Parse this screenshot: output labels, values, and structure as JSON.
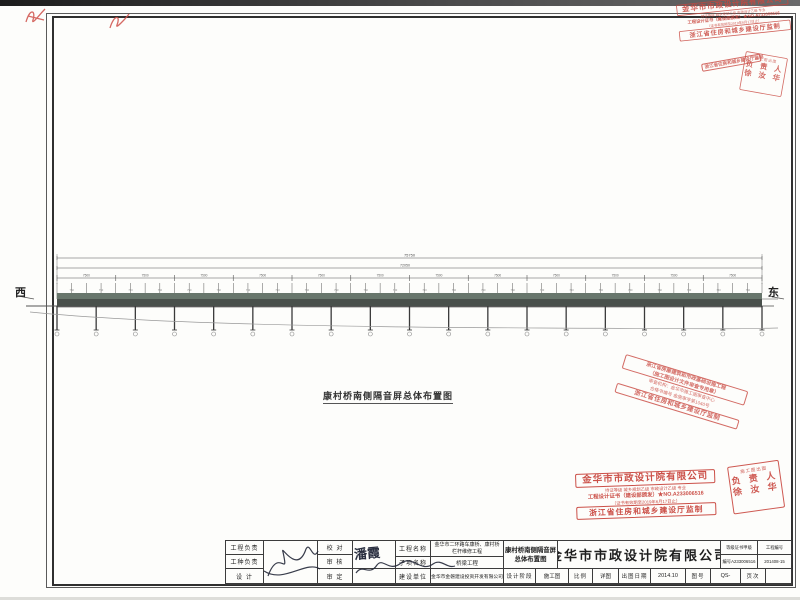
{
  "colors": {
    "stamp_red": "#c9473f",
    "ink": "#2a2f40",
    "deck_dark": "#49504b",
    "deck_hatch": "#77857a"
  },
  "orientation": {
    "west": "西",
    "east": "东"
  },
  "caption": "康村桥南侧隔音屏总体布置图",
  "drawing": {
    "total_dim": "75750",
    "sub_dim": "72050",
    "span_dim": "7500",
    "panel_dim": "750",
    "spans": 12,
    "piers": 19,
    "posts": 48
  },
  "review_stamp": {
    "top1": "浙江省房屋建筑和市政基础设施工程",
    "top2": "（施工图设计文件审查专用章）",
    "mid1": "审查机构：金华市施工图审查中心",
    "mid2": "合格书编号 金施审字第1040号",
    "bottom": "浙江省住房和城乡建设厅监制"
  },
  "certificate_stamp": {
    "company": "金华市市政设计院有限公司",
    "line2": "持证等级 城乡规划乙级 市政设计乙级 专业",
    "line3": "工程设计证书（建设部颁发）★NO.A233006516",
    "line4": "（证书有效期至2019年6月17日止）",
    "footer": "浙江省住房和城乡建设厅监制"
  },
  "square_stamp": {
    "line1": "施工图出图",
    "line2": "负 责 人",
    "line3": "徐 汝 华"
  },
  "title_block": {
    "row_labels_1": [
      "工程负责",
      "工种负责",
      "设  计"
    ],
    "row_labels_2": [
      "校  对",
      "审  核",
      "审  定"
    ],
    "reviewer_signature": "潘霞",
    "project_label": "工程名称",
    "project_value_line1": "金华市二环路车康桥、康村桥",
    "project_value_line2": "栏杆维修工程",
    "subitem_label": "子项名称",
    "subitem_value": "桥梁工程",
    "owner_label": "建设单位",
    "owner_value": "金华市金磐建设投资开发有限公司",
    "drawing_title_line1": "康村桥南侧隔音屏",
    "drawing_title_line2": "总体布置图",
    "company": "金华市市政设计院有限公司",
    "cert_grade_label": "等级证书甲级",
    "cert_grade_value": "编号A233006516",
    "project_no_label": "工程编号",
    "project_no_value": "201408-15",
    "stage_label": "设计阶段",
    "stage_value": "施工图",
    "scale_label": "比例",
    "scale_value": "详图",
    "date_label": "出图日期",
    "date_value": "2014.10",
    "figno_label": "图号",
    "figno_value": "QS-",
    "page_label": "页次",
    "page_value": ""
  }
}
